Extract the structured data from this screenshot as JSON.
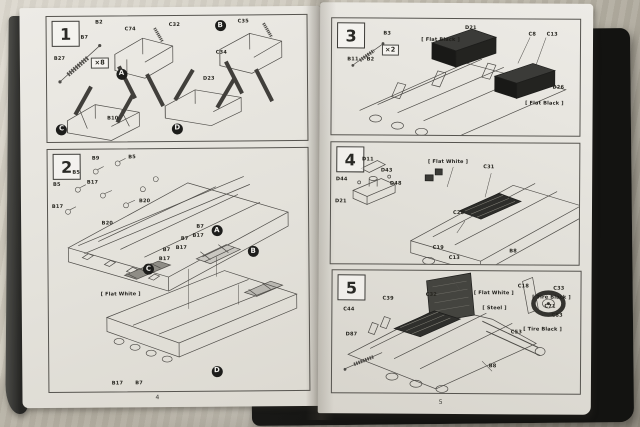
{
  "scene": {
    "fabric_color": "#c8c3b6",
    "cover_color": "#1a1a18",
    "page_color": "#e9e7e2",
    "diagram_line_color": "#4e4c48",
    "text_color": "#26251f"
  },
  "pages": {
    "left_number": "4",
    "right_number": "5"
  },
  "steps": [
    {
      "number": "1",
      "annotations": [
        {
          "kind": "part",
          "text": "B2",
          "x": 18.7,
          "y": 3.4
        },
        {
          "kind": "part",
          "text": "B7",
          "x": 13,
          "y": 15
        },
        {
          "kind": "part",
          "text": "B27",
          "x": 2.7,
          "y": 32
        },
        {
          "kind": "multiplier",
          "text": "×8",
          "x": 17,
          "y": 33
        },
        {
          "kind": "part",
          "text": "C74",
          "x": 30,
          "y": 8.8
        },
        {
          "kind": "part",
          "text": "C32",
          "x": 47,
          "y": 5.5
        },
        {
          "kind": "callout",
          "text": "A",
          "x": 28.7,
          "y": 46
        },
        {
          "kind": "callout",
          "text": "B",
          "x": 66.8,
          "y": 8
        },
        {
          "kind": "part",
          "text": "C35",
          "x": 73.5,
          "y": 3.2
        },
        {
          "kind": "part",
          "text": "C34",
          "x": 65,
          "y": 28
        },
        {
          "kind": "callout",
          "text": "C",
          "x": 5.5,
          "y": 90
        },
        {
          "kind": "part",
          "text": "B10",
          "x": 23,
          "y": 80
        },
        {
          "kind": "callout",
          "text": "D",
          "x": 50,
          "y": 90
        },
        {
          "kind": "part",
          "text": "D23",
          "x": 60,
          "y": 49
        }
      ]
    },
    {
      "number": "2",
      "annotations": [
        {
          "kind": "part",
          "text": "B9",
          "x": 17,
          "y": 3
        },
        {
          "kind": "part",
          "text": "B5",
          "x": 31,
          "y": 2.5
        },
        {
          "kind": "part",
          "text": "B5",
          "x": 9.5,
          "y": 8.7
        },
        {
          "kind": "part",
          "text": "B17",
          "x": 15,
          "y": 13
        },
        {
          "kind": "part",
          "text": "B5",
          "x": 2,
          "y": 13.6
        },
        {
          "kind": "part",
          "text": "B20",
          "x": 35,
          "y": 20.6
        },
        {
          "kind": "part",
          "text": "B17",
          "x": 1.5,
          "y": 22.7
        },
        {
          "kind": "part",
          "text": "B20",
          "x": 20.6,
          "y": 29.7
        },
        {
          "kind": "part",
          "text": "B7",
          "x": 57,
          "y": 31.5
        },
        {
          "kind": "part",
          "text": "B17",
          "x": 55.5,
          "y": 35
        },
        {
          "kind": "part",
          "text": "B7",
          "x": 51,
          "y": 36.5
        },
        {
          "kind": "part",
          "text": "B17",
          "x": 49,
          "y": 40
        },
        {
          "kind": "part",
          "text": "B7",
          "x": 44,
          "y": 41
        },
        {
          "kind": "part",
          "text": "B17",
          "x": 42.5,
          "y": 44.5
        },
        {
          "kind": "callout",
          "text": "A",
          "x": 64.9,
          "y": 33.9
        },
        {
          "kind": "callout",
          "text": "B",
          "x": 78.8,
          "y": 42.6
        },
        {
          "kind": "callout",
          "text": "C",
          "x": 38.5,
          "y": 49.6
        },
        {
          "kind": "note",
          "text": "[ Flat White ]",
          "x": 20,
          "y": 59
        },
        {
          "kind": "part",
          "text": "B17",
          "x": 24,
          "y": 96
        },
        {
          "kind": "part",
          "text": "B7",
          "x": 33,
          "y": 96
        },
        {
          "kind": "callout",
          "text": "D",
          "x": 64.5,
          "y": 92
        }
      ]
    },
    {
      "number": "3",
      "annotations": [
        {
          "kind": "part",
          "text": "B3",
          "x": 20.7,
          "y": 11
        },
        {
          "kind": "multiplier",
          "text": "×2",
          "x": 20,
          "y": 22
        },
        {
          "kind": "part",
          "text": "B11",
          "x": 6.2,
          "y": 34
        },
        {
          "kind": "part",
          "text": "B2",
          "x": 14,
          "y": 34
        },
        {
          "kind": "note",
          "text": "[ Flat Black ]",
          "x": 36,
          "y": 16
        },
        {
          "kind": "part",
          "text": "D21",
          "x": 53.6,
          "y": 6
        },
        {
          "kind": "part",
          "text": "C8",
          "x": 79.2,
          "y": 11
        },
        {
          "kind": "part",
          "text": "C13",
          "x": 86.5,
          "y": 11
        },
        {
          "kind": "part",
          "text": "D26",
          "x": 89,
          "y": 57
        },
        {
          "kind": "note",
          "text": "[ Flat Black ]",
          "x": 78,
          "y": 71
        }
      ]
    },
    {
      "number": "4",
      "annotations": [
        {
          "kind": "part",
          "text": "D11",
          "x": 12.4,
          "y": 12
        },
        {
          "kind": "part",
          "text": "D43",
          "x": 20,
          "y": 21.5
        },
        {
          "kind": "part",
          "text": "D44",
          "x": 1.9,
          "y": 29
        },
        {
          "kind": "part",
          "text": "D48",
          "x": 23.7,
          "y": 32.5
        },
        {
          "kind": "part",
          "text": "D21",
          "x": 1.6,
          "y": 47.5
        },
        {
          "kind": "note",
          "text": "[ Flat White ]",
          "x": 39,
          "y": 14
        },
        {
          "kind": "part",
          "text": "C31",
          "x": 61.3,
          "y": 18
        },
        {
          "kind": "part",
          "text": "C28",
          "x": 49.2,
          "y": 56.5
        },
        {
          "kind": "part",
          "text": "C19",
          "x": 41.1,
          "y": 85
        },
        {
          "kind": "part",
          "text": "C13",
          "x": 47.6,
          "y": 93
        },
        {
          "kind": "part",
          "text": "B8",
          "x": 72,
          "y": 87.5
        }
      ]
    },
    {
      "number": "5",
      "annotations": [
        {
          "kind": "part",
          "text": "C44",
          "x": 4.4,
          "y": 30.5
        },
        {
          "kind": "part",
          "text": "C39",
          "x": 20.2,
          "y": 21
        },
        {
          "kind": "part",
          "text": "C32",
          "x": 37.6,
          "y": 18
        },
        {
          "kind": "part",
          "text": "D87",
          "x": 5.4,
          "y": 51
        },
        {
          "kind": "note",
          "text": "[ Flat White ]",
          "x": 57,
          "y": 16
        },
        {
          "kind": "note",
          "text": "[ Steel ]",
          "x": 60.5,
          "y": 29
        },
        {
          "kind": "part",
          "text": "C18",
          "x": 74.7,
          "y": 11
        },
        {
          "kind": "part",
          "text": "C33",
          "x": 89,
          "y": 12
        },
        {
          "kind": "note",
          "text": "[ Tire Black ]",
          "x": 80.5,
          "y": 19.5
        },
        {
          "kind": "part",
          "text": "C71",
          "x": 85.5,
          "y": 27
        },
        {
          "kind": "part",
          "text": "C83",
          "x": 88.4,
          "y": 34.5
        },
        {
          "kind": "note",
          "text": "[ Tire Black ]",
          "x": 77,
          "y": 45.5
        },
        {
          "kind": "part",
          "text": "C53",
          "x": 72,
          "y": 48
        },
        {
          "kind": "part",
          "text": "B8",
          "x": 63.2,
          "y": 76
        }
      ]
    }
  ]
}
